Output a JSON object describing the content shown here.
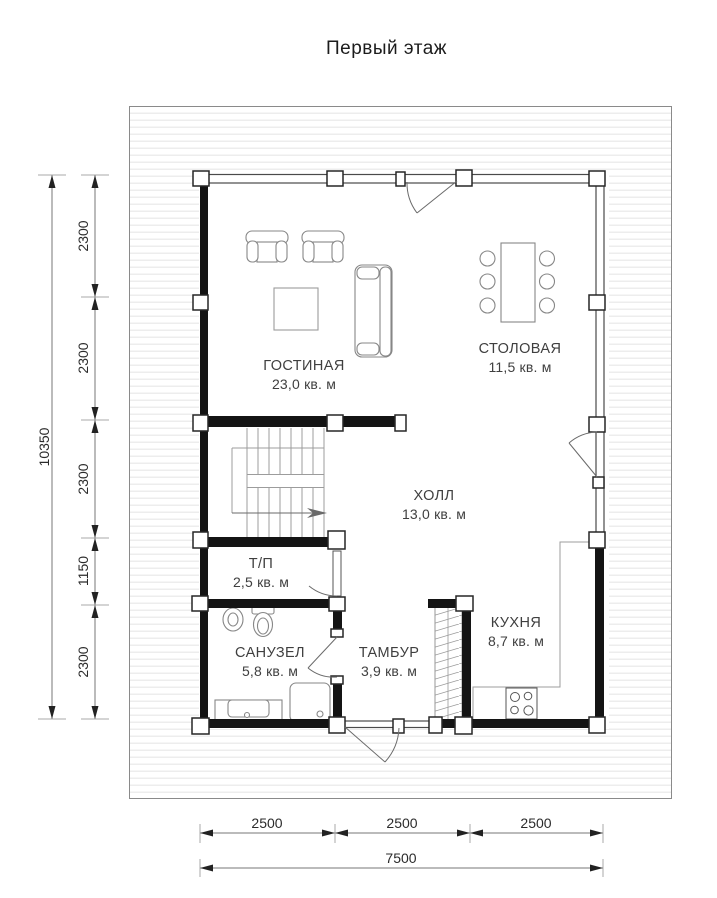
{
  "title": "Первый этаж",
  "rooms": {
    "living": {
      "name": "ГОСТИНАЯ",
      "area": "23,0 кв. м"
    },
    "dining": {
      "name": "СТОЛОВАЯ",
      "area": "11,5 кв. м"
    },
    "hall": {
      "name": "ХОЛЛ",
      "area": "13,0 кв. м"
    },
    "utility": {
      "name": "Т/П",
      "area": "2,5 кв. м"
    },
    "bathroom": {
      "name": "САНУЗЕЛ",
      "area": "5,8 кв. м"
    },
    "vestibule": {
      "name": "ТАМБУР",
      "area": "3,9 кв. м"
    },
    "kitchen": {
      "name": "КУХНЯ",
      "area": "8,7 кв. м"
    }
  },
  "dimensions": {
    "left": {
      "total": "10350",
      "segments": [
        "2300",
        "2300",
        "2300",
        "1150",
        "2300"
      ]
    },
    "bottom": {
      "total": "7500",
      "segments": [
        "2500",
        "2500",
        "2500"
      ]
    }
  },
  "colors": {
    "wall": "#141414",
    "thin_line": "#4a4a4a",
    "furniture_line": "#878787",
    "dimension_line": "#777777",
    "text": "#3f3f3f",
    "site_stripe": "#ededed"
  }
}
